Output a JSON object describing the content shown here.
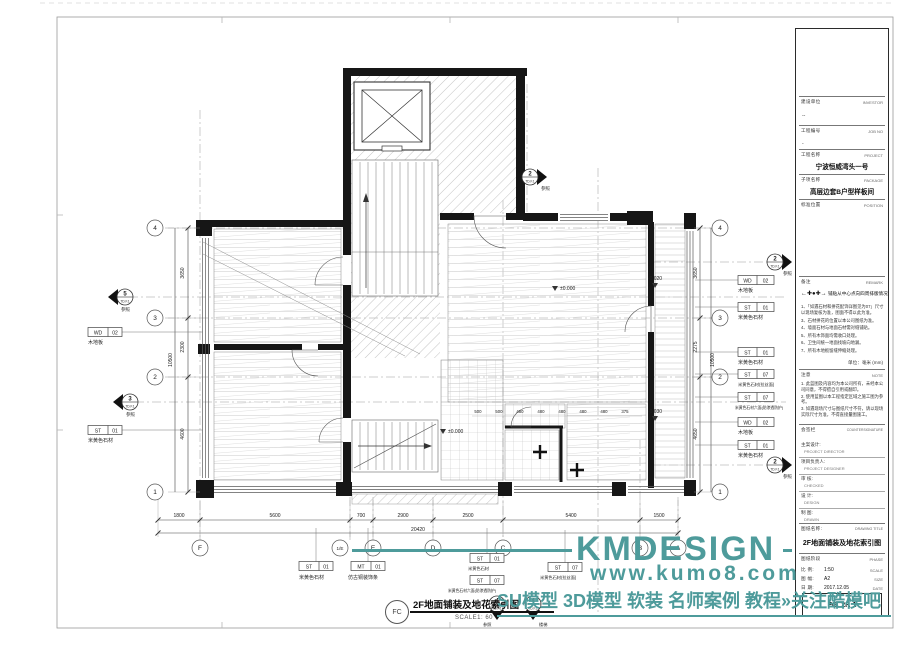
{
  "watermark": {
    "brand": "KMDESIGN",
    "url": "www.kumo8.com",
    "promo": "SU模型 3D模型 软装 名师案例 教程»关注酷模吧",
    "color": "#4e9b9b"
  },
  "label": {
    "ref": "FC",
    "title": "2F地面铺装及地花索引图",
    "scale": "SCALE1: 60"
  },
  "plan": {
    "row_bubbles": [
      "4",
      "3",
      "2",
      "1"
    ],
    "col_bubbles": [
      "F",
      "1/E",
      "E",
      "D",
      "C",
      "B",
      "A"
    ],
    "left_dims": [
      "3650",
      "2300",
      "4600"
    ],
    "left_total": "10500",
    "right_dims": [
      "3650",
      "2275",
      "4650"
    ],
    "right_total": "10500",
    "bottom_dims": [
      "1800",
      "5600",
      "700",
      "2900",
      "2500",
      "5400",
      "1500"
    ],
    "bottom_total": "20420",
    "tile_dims": [
      "500",
      "500",
      "480",
      "480",
      "480",
      "480",
      "480",
      "375"
    ],
    "levels": [
      {
        "v": "±0.000"
      },
      {
        "v": "±0.000"
      },
      {
        "v": "-0.020"
      },
      {
        "v": "-0.030"
      }
    ],
    "tags_left": [
      {
        "c": "WD",
        "n": "02",
        "cap": "木地板"
      },
      {
        "c": "ST",
        "n": "01",
        "cap": "米黄色石材"
      }
    ],
    "tags_right": [
      {
        "c": "WD",
        "n": "02",
        "cap": "木地板"
      },
      {
        "c": "ST",
        "n": "01",
        "cap": "米黄色石材"
      },
      {
        "c": "ST",
        "n": "01",
        "cap": "米黄色石材"
      },
      {
        "c": "ST",
        "n": "07",
        "cap": "米黄色石材(拉丝面)"
      },
      {
        "c": "ST",
        "n": "07",
        "cap": "米黄色石材六面(防渗透防护)"
      },
      {
        "c": "WD",
        "n": "02",
        "cap": "木地板"
      },
      {
        "c": "ST",
        "n": "01",
        "cap": "米黄色石材"
      }
    ],
    "tags_bottom": [
      {
        "c": "ST",
        "n": "01",
        "cap": "米黄色石材"
      },
      {
        "c": "MT",
        "n": "01",
        "cap": "仿古铜装饰条"
      },
      {
        "c": "ST",
        "n": "01",
        "cap": "米黄色石材"
      },
      {
        "c": "ST",
        "n": "07",
        "cap": "米黄色石材六面(防渗透防护)"
      },
      {
        "c": "ST",
        "n": "07",
        "cap": "米黄色石材(拉丝面)"
      }
    ],
    "sections": [
      {
        "num": "2",
        "ref": "TD.F.1",
        "cap": "参照"
      },
      {
        "num": "5",
        "ref": "TD.F.1",
        "cap": "参照"
      },
      {
        "num": "3",
        "ref": "TD.F.1",
        "cap": "参照"
      },
      {
        "num": "2",
        "ref": "TD.F.1",
        "cap": "参照"
      },
      {
        "num": "2",
        "ref": "TD.F.1",
        "cap": "参照"
      },
      {
        "num": "4",
        "ref": "TD.F.1",
        "cap": "参照"
      },
      {
        "num": "4",
        "ref": "TD.F.1",
        "cap": "楼梯"
      }
    ]
  },
  "title_block": {
    "investor_zh": "建设单位",
    "investor_en": "INVESTOR",
    "investor_value": "--",
    "job_zh": "工程编号",
    "job_en": "JOB NO",
    "job_value": "-",
    "project_zh": "工程名称",
    "project_en": "PROJECT",
    "project_value": "宁波恒威湾头一号",
    "package_zh": "子项名称",
    "package_en": "PACKAGE",
    "package_value": "高层边套B户型样板间",
    "position_zh": "标准位置",
    "position_en": "POSITION",
    "remark_zh": "备注",
    "remark_en": "REMARK",
    "remark_symbol_caption": "铺贴从中心点向四周排版情况",
    "remark_notes": [
      "1、「如遇石材和拼花配饰详图见为07」尺寸以现场复核为准，图面不得以此为准。",
      "3、石材拼花的位置以本公司图纸为准。",
      "4、墙面石材与地面石材需对缝铺贴。",
      "5、所有木饰面均需收口处理。",
      "6、卫生间统一地面找坡向地漏。",
      "7、所有木地板留缝伸缩处理。"
    ],
    "unit_label": "单位：毫米 (mm)",
    "note_zh": "注意",
    "note_en": "NOTE",
    "notes": [
      "1. 此蓝图及内容均为本公司所有，未经本公司同意，不得擅自引用或翻印。",
      "2. 使用蓝图以本工程指定区域之施工图为参考。",
      "3. 如遇现场尺寸与图纸尺寸不符，请以现场实际尺寸为准，不得直接量图施工。"
    ],
    "countersign_zh": "会签栏",
    "countersign_en": "COUNTERSIGNATURE",
    "roles": [
      {
        "zh": "主案设计:",
        "en": "PROJECT DIRECTOR"
      },
      {
        "zh": "项目负责人:",
        "en": "PROJECT DESIGNER"
      },
      {
        "zh": "审 核:",
        "en": "CHECKED"
      },
      {
        "zh": "设 计:",
        "en": "DESIGN"
      },
      {
        "zh": "制 图:",
        "en": "DRAWN"
      }
    ],
    "dtitle_zh": "图纸名称:",
    "dtitle_en": "DRAWING TITLE",
    "dtitle_value": "2F地面铺装及地花索引图",
    "phase_zh": "图纸阶段",
    "phase_en": "PHASE",
    "scale_zh": "比 例:",
    "scale_value": "1:50",
    "scale_en": "SCALE",
    "size_zh": "图 幅:",
    "size_value": "A2",
    "size_en": "SIZE",
    "date_zh": "日 期:",
    "date_value": "2017.12.05",
    "date_en": "DATE",
    "drawing_no": "FG. 2F. 1"
  }
}
